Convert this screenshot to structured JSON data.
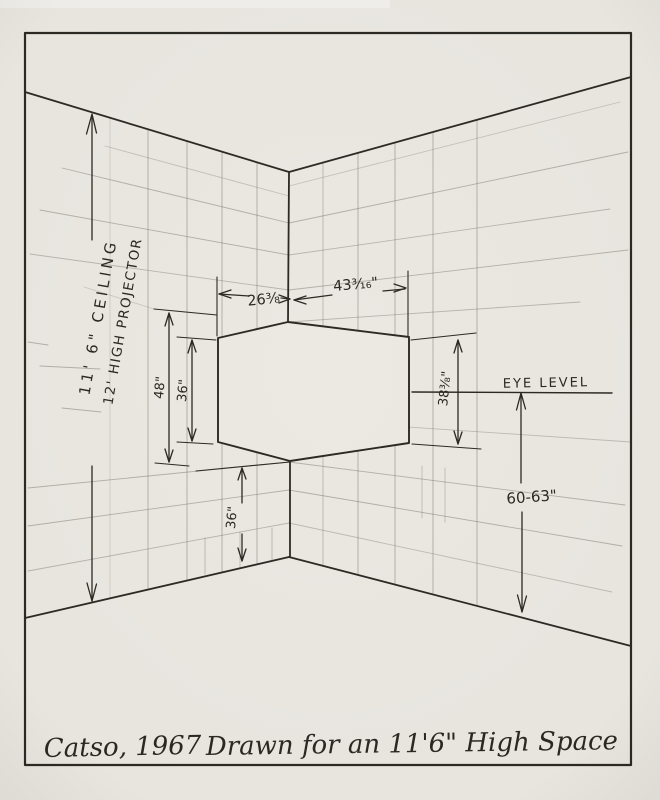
{
  "drawing": {
    "type": "hand-drawn perspective installation diagram",
    "labels": {
      "ceiling_height": "11' 6\" CEILING",
      "projector_height": "12' HIGH PROJECTOR",
      "dim_top_left": "26⅜",
      "dim_top_right": "43³⁄₁₆\"",
      "dim_48": "48\"",
      "dim_36_left": "36\"",
      "dim_38": "38⅜\"",
      "eye_level": "EYE LEVEL",
      "dim_60_63": "60-63\"",
      "dim_36_bottom": "36\"",
      "caption_title": "Catso, 1967",
      "caption_note": "Drawn for an 11'6\" High Space"
    },
    "colors": {
      "paper": "#ebe8e2",
      "ink": "#2c2a24",
      "pencil": "#7b7770"
    }
  }
}
